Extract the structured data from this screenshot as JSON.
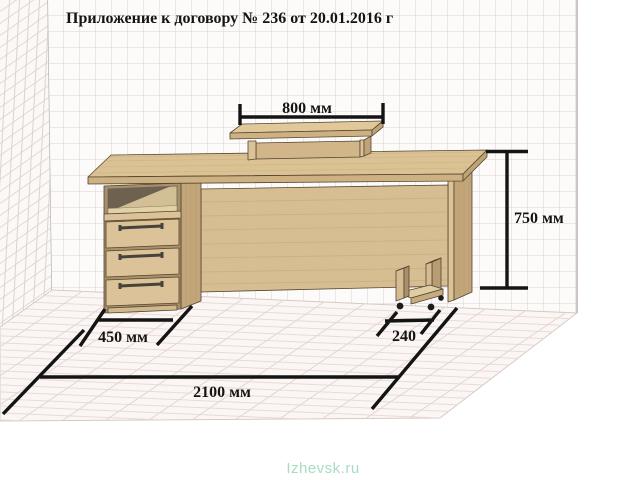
{
  "title": "Приложение к договору № 236 от 20.01.2016 г",
  "watermark": "Izhevsk.ru",
  "dimensions": {
    "shelf_width": "800 мм",
    "height": "750 мм",
    "pedestal_width": "450 мм",
    "stand_width": "240",
    "total_length": "2100 мм"
  },
  "dimensions_mm": {
    "shelf_width": 800,
    "height": 750,
    "pedestal_width": 450,
    "stand_width": 240,
    "total_length": 2100
  },
  "scene": {
    "object": "office desk with drawer pedestal, monitor shelf and CPU stand",
    "drawers_count": 3
  },
  "colors": {
    "dimension_line": "#141414",
    "title_text": "#161412",
    "wall_grid_line": "#ddd2d2",
    "floor_line": "#e7dbd8",
    "wood_top": "#dbc294",
    "wood_front": "#dcc298",
    "wood_edge": "#cdb183",
    "wood_side": "#c2a67a",
    "wood_dark_base": "#a8906b",
    "watermark": "#a9dcc3"
  }
}
